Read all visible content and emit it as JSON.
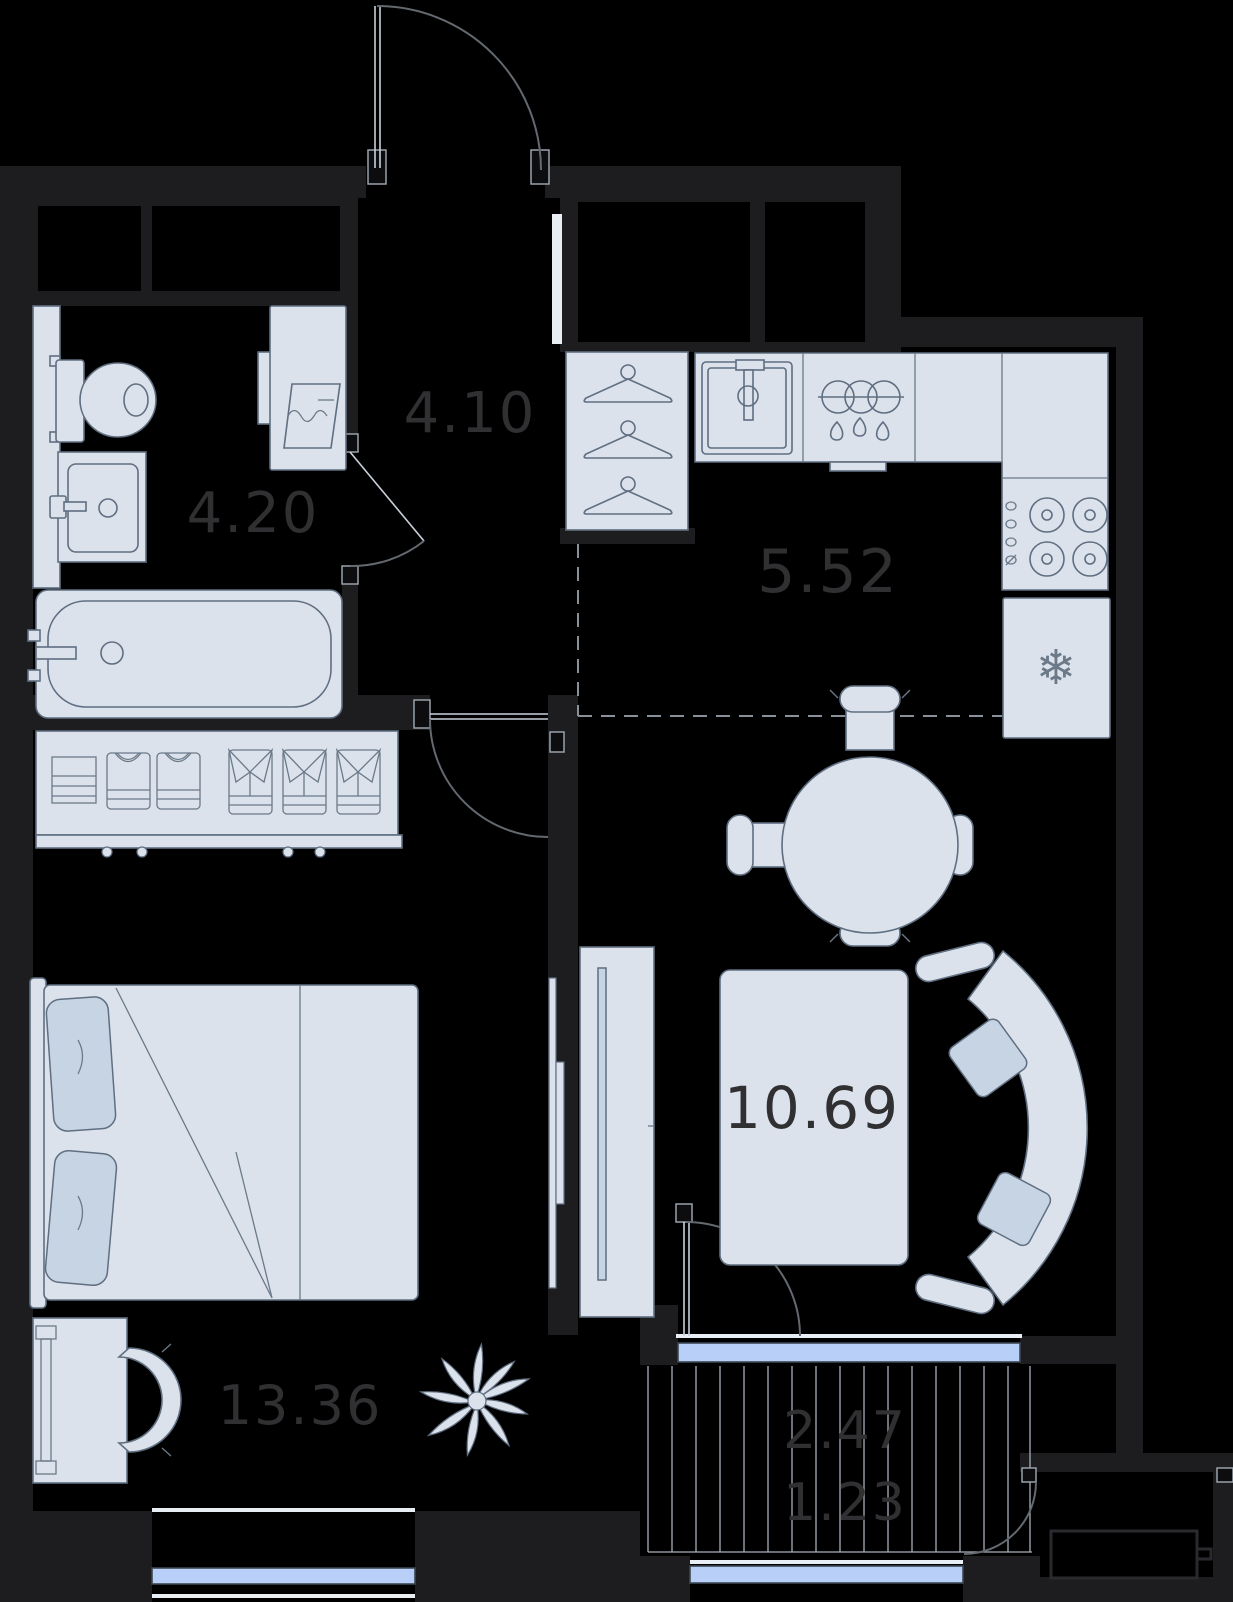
{
  "floorplan": {
    "type": "apartment-floor-plan",
    "room_labels": {
      "hallway": "4.10",
      "bathroom": "4.20",
      "kitchen": "5.52",
      "living_dining": "10.69",
      "bedroom": "13.36",
      "balcony_full": "2.47",
      "balcony_reduced": "1.23"
    },
    "icons": {
      "freezer_snowflake": "❄"
    },
    "colors": {
      "background": "#000000",
      "wall": "#1d1d20",
      "furniture_fill": "#dbe2ec",
      "furniture_stroke": "#5f6e80",
      "pillow_fill": "#c6d4e3",
      "window_glazing": "#b8d0f8",
      "label_text": "#303032",
      "hatch_line": "#a7b0ba",
      "dashed_zone_line": "#8a9097"
    }
  }
}
